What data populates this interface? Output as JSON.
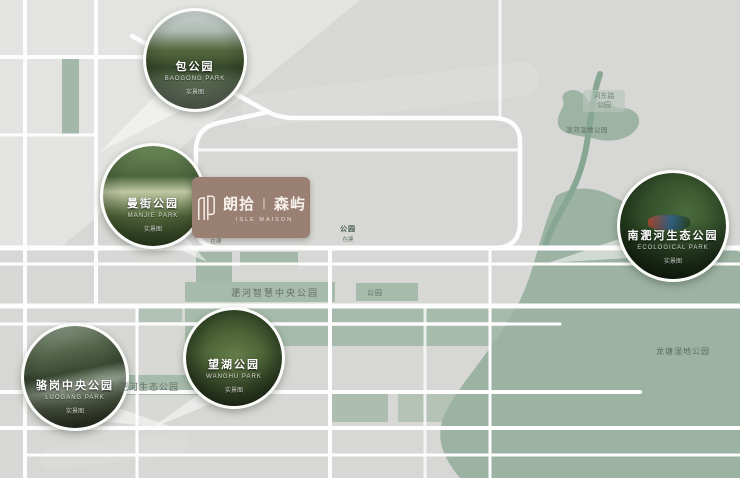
{
  "project": {
    "name_left": "朗拾",
    "divider": "丨",
    "name_right": "森屿",
    "en": "ISLE MAISON"
  },
  "parks": [
    {
      "name": "包公园",
      "en": "BAOGONG PARK",
      "tag": "实景图"
    },
    {
      "name": "曼街公园",
      "en": "MANJIE PARK",
      "tag": "实景图"
    },
    {
      "name": "南淝河生态公园",
      "en": "ECOLOGICAL PARK",
      "tag": "实景图"
    },
    {
      "name": "骆岗中央公园",
      "en": "LUOGANG PARK",
      "tag": "实景图"
    },
    {
      "name": "望湖公园",
      "en": "WANGHU PARK",
      "tag": "实景图"
    }
  ],
  "labels": {
    "smart_park": "淝河智慧中央公园",
    "eco_park": "淝河生态公园",
    "longtang": "龙塘湿地公园",
    "wetland": "滨河湿地公园",
    "hedong_line1": "河东路",
    "hedong_line2": "公园",
    "mini_park": "公园",
    "patch_left_title": "公园",
    "patch_left_sub": "在建",
    "patch_right_title": "公园",
    "patch_right_sub": "在建"
  },
  "colors": {
    "background": "#d7d8d5",
    "road": "#fdfdfd",
    "park_green": "#a3b8a8",
    "river": "#88a694",
    "big_green": "#9cb2a2",
    "badge": "#9a8073"
  }
}
